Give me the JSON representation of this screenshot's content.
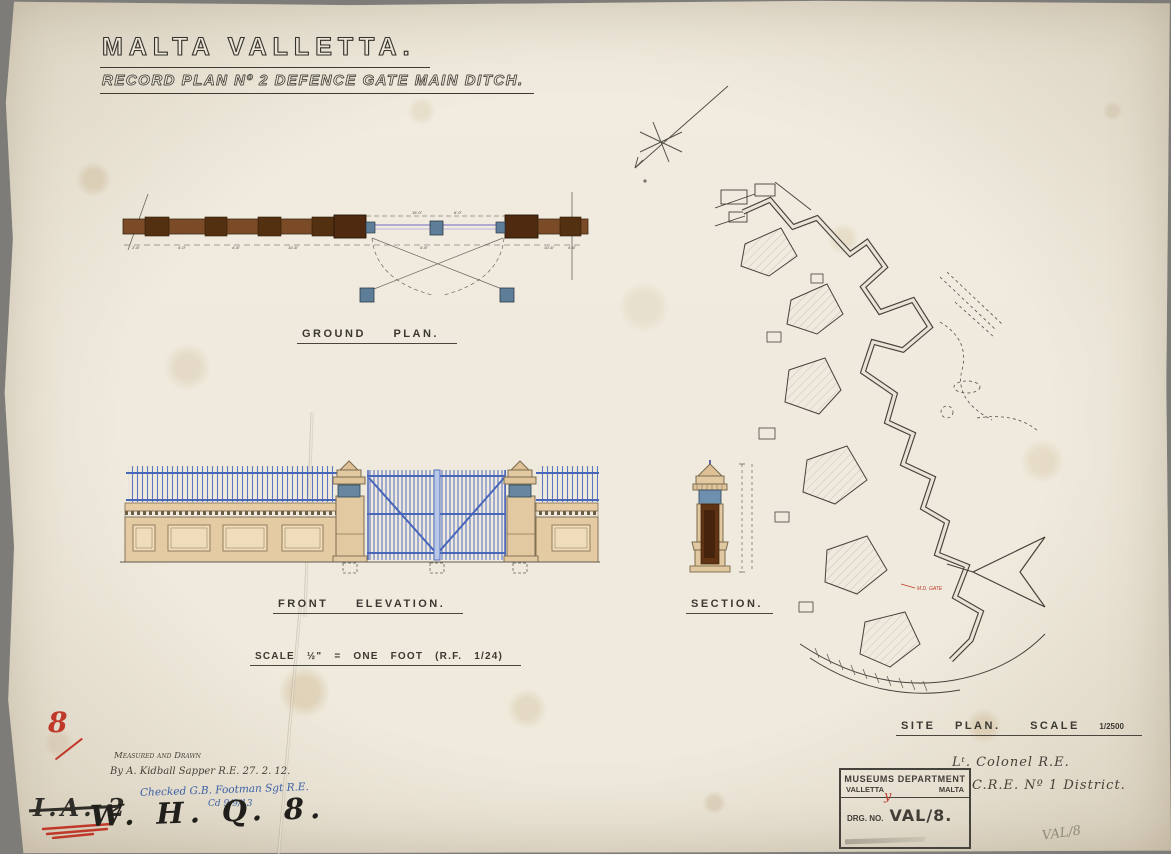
{
  "header": {
    "title": "MALTA  VALLETTA.",
    "subtitle": "RECORD PLAN Nº 2 DEFENCE GATE MAIN DITCH."
  },
  "labels": {
    "ground_plan": "GROUND  PLAN.",
    "front_elevation": "FRONT  ELEVATION.",
    "scale_line": "SCALE  ½\" =  ONE FOOT    (R.F. 1/24)",
    "section": "SECTION.",
    "site_plan": "SITE  PLAN.",
    "site_scale_word": "SCALE",
    "site_scale_value": "1/2500"
  },
  "ground_plan": {
    "dims": [
      "2'-6\"",
      "4'-0\"",
      "4'-6\"",
      "10'-6\"",
      "4'-6\"",
      "10'-6\"",
      "4'-6\"",
      "15'-0\"",
      "6'-0\""
    ]
  },
  "site_plan": {
    "gate_label": "M.D. GATE"
  },
  "notes": {
    "measured_line1": "Measured  and  Drawn",
    "measured_line2": "By  A. Kidball  Sapper R.E.   27. 2. 12.",
    "checked_line": "Checked  G.B. Footman  Sgt R.E.",
    "checked_date": "Cd  9/9/13",
    "red_number": "8",
    "crossed_ref": "I.A. 2",
    "whq_ref": "W. H. Q. 8.",
    "pencil_ref": "VAL/8",
    "red_tick": "y"
  },
  "signoff": {
    "line1": "Lᵗ. Colonel R.E.",
    "line2": "C.R.E. Nº 1 District."
  },
  "stamp": {
    "title": "MUSEUMS  DEPARTMENT",
    "left": "VALLETTA",
    "right": "MALTA",
    "drg_label": "DRG. NO.",
    "drg_value": "VAL/8."
  }
}
